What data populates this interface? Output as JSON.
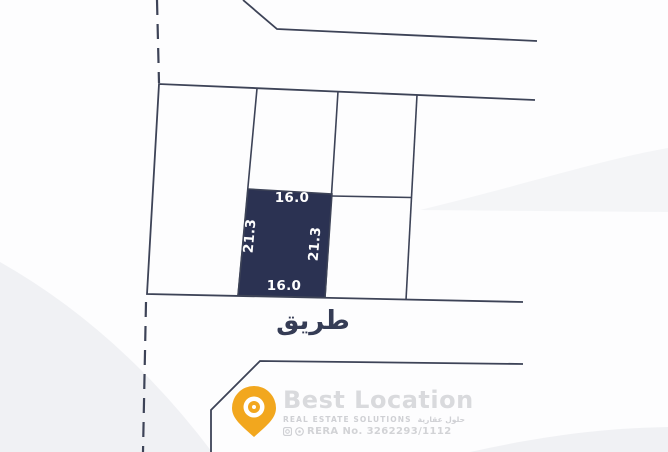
{
  "map": {
    "plot": {
      "dim_top": "16.0",
      "dim_bottom": "16.0",
      "dim_left": "21.3",
      "dim_right": "21.3"
    },
    "road_label": "طريق"
  },
  "watermark": {
    "brand": "Best Location",
    "tagline_en": "REAL ESTATE SOLUTIONS",
    "tagline_ar": "حلول عقارية",
    "rera": "RERA No. 3262293/1112"
  },
  "colors": {
    "plot_fill": "#2b3252",
    "boundary_line": "#3d4357",
    "pin_orange": "#F2A71E",
    "road_text": "#353c55"
  }
}
